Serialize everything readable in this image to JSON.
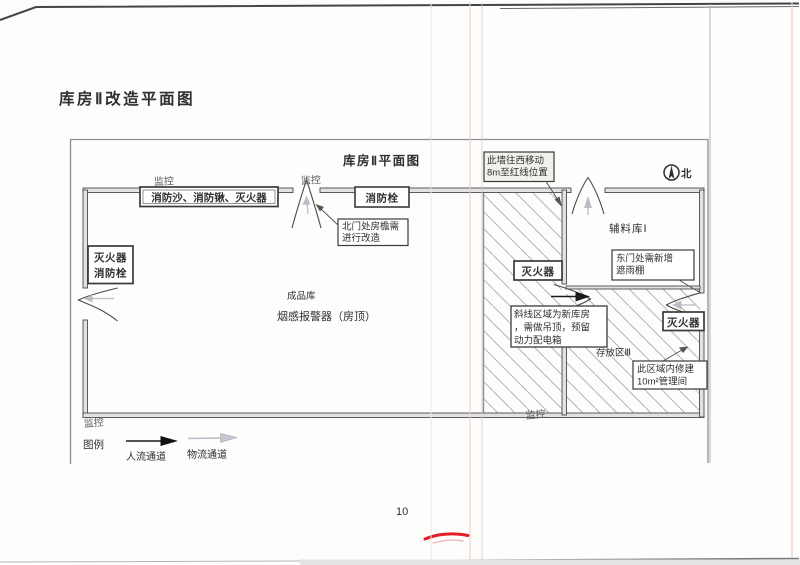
{
  "page": {
    "title": "库房Ⅱ改造平面图",
    "number": "10"
  },
  "plan": {
    "title": "库房Ⅱ平面图",
    "north": "北"
  },
  "labels": {
    "monitor": "监控",
    "finished_goods": "成品库",
    "smoke_detector": "烟感报警器（房顶）",
    "aux_warehouse": "辅料库Ⅰ",
    "storage_area": "存放区Ⅲ"
  },
  "boxes": {
    "fire_supplies": "消防沙、消防锹、灭火器",
    "hydrant": "消防栓",
    "extinguisher": "灭火器",
    "ext_hydrant": {
      "line1": "灭火器",
      "line2": "消防栓"
    },
    "move_wall": {
      "line1": "此墙往西移动",
      "line2": "8m至红线位置"
    },
    "eaves": {
      "line1": "北门处房檐需",
      "line2": "进行改造"
    },
    "canopy": {
      "line1": "东门处需新增",
      "line2": "遮雨棚"
    },
    "new_warehouse": {
      "line1": "斜线区域为新库房",
      "line2": "，需做吊顶，预留",
      "line3": "动力配电箱"
    },
    "mgmt_room": {
      "line1": "此区域内修建",
      "line2": "10m²管理间"
    }
  },
  "legend": {
    "title": "图例",
    "people": "人流通道",
    "logistics": "物流通道"
  },
  "colors": {
    "red_mark": "#e31c25",
    "hatch": "#b3b3b8",
    "gray_arrow": "#b9bec6",
    "fold_pink": "#eecdd2",
    "ink": "#3f3f3f"
  }
}
